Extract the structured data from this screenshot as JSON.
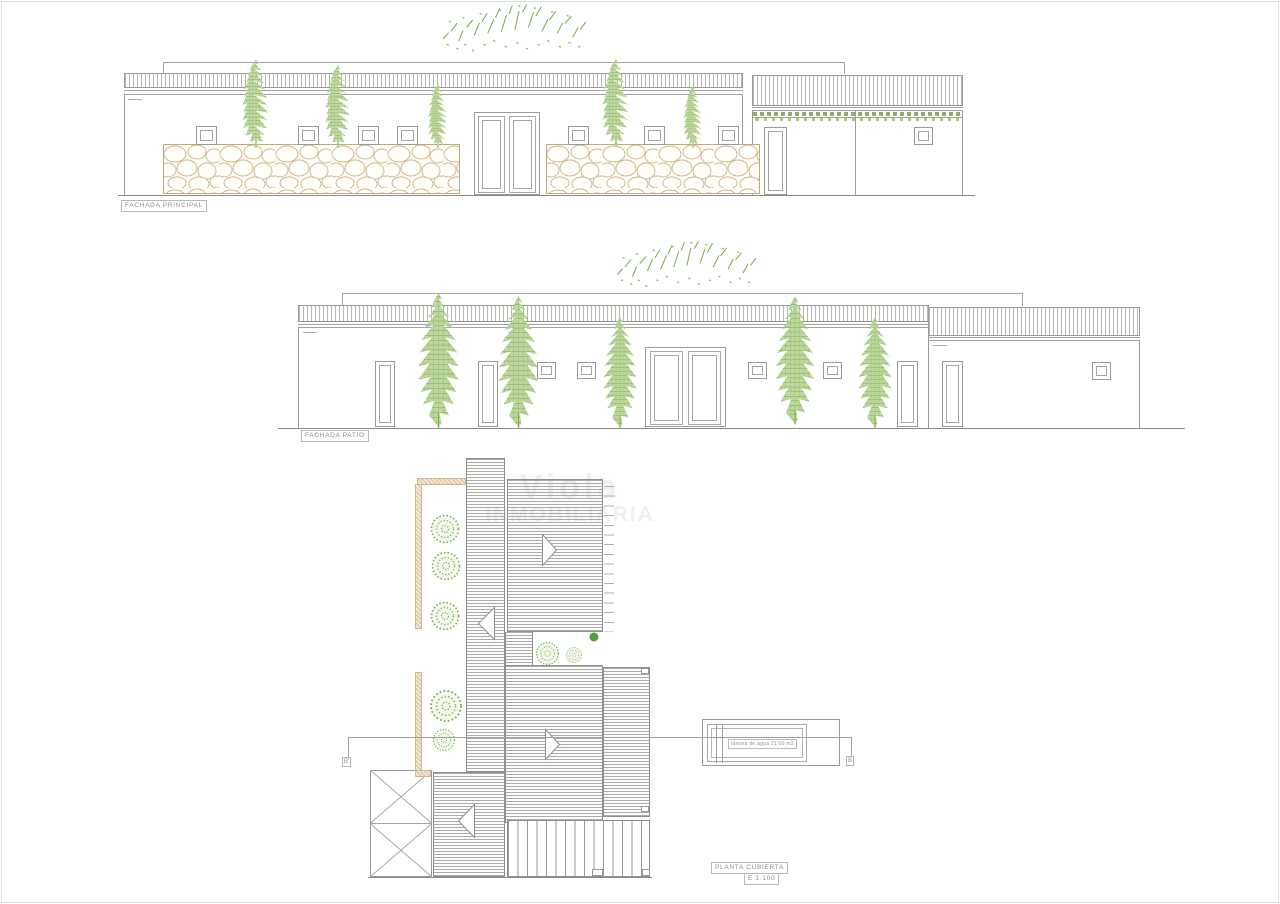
{
  "sheet": {
    "title": "architectural plans sheet"
  },
  "drawings": {
    "fachada_principal": {
      "label": "FACHADA PRINCIPAL"
    },
    "fachada_patio": {
      "label": "FACHADA PATIO"
    },
    "planta_cubierta": {
      "label": "PLANTA CUBIERTA",
      "scale": "E 1:100",
      "pool_label": "lámina de agua 21'00 m2",
      "section_marker_left": "B'",
      "section_marker_right": "B"
    }
  },
  "watermark": {
    "line1": "Viola",
    "line2": "INMOBILIARIA"
  },
  "colors": {
    "line": "#9a9a9a",
    "green": "#7fae53",
    "stone_tan": "#cdb28a"
  }
}
